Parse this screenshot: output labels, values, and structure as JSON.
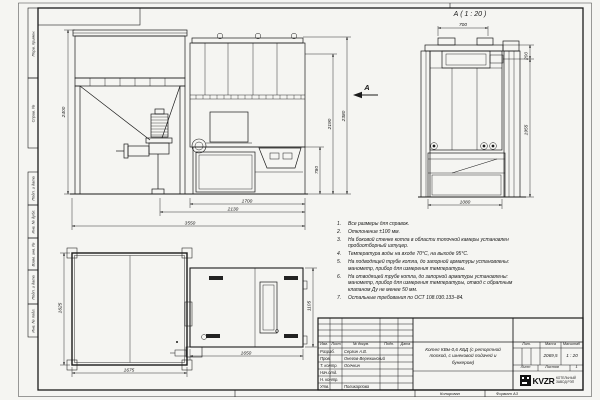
{
  "drawing": {
    "section_label": "А ( 1 : 20 )",
    "view_arrow_label": "А",
    "front_view": {
      "dim_height": "2400",
      "dim_right_1": "780",
      "dim_right_2": "2190",
      "dim_right_3": "2380",
      "dim_bottom_1": "1700",
      "dim_bottom_2": "2130",
      "dim_bottom_3": "3550"
    },
    "section_view": {
      "dim_top": "700",
      "dim_right_1": "200",
      "dim_right_2": "1955",
      "dim_bottom": "1080"
    },
    "plan_view": {
      "dim_left": "1625",
      "dim_bottom_bunker": "1675",
      "dim_bottom_boiler": "1650",
      "dim_right": "1105"
    }
  },
  "notes": {
    "items": [
      {
        "n": "1.",
        "text": "Все размеры для справок."
      },
      {
        "n": "2.",
        "text": "Отклонение ±100 мм."
      },
      {
        "n": "3.",
        "text": "На боковой стенке котла в области топочной камеры установлен пробоотборный штуцер."
      },
      {
        "n": "4.",
        "text": "Температура воды на входе 70°С, на выходе 95°С."
      },
      {
        "n": "5.",
        "text": "На подводящей трубе котла, до запорной арматуры установлены: манометр, прибор для измерения температуры."
      },
      {
        "n": "6.",
        "text": "На отводящей трубе котла, до запорной арматуры установлены: манометр, прибор для измерения температуры, отвод с обратным клапаном Ду не менее 50 мм."
      },
      {
        "n": "7.",
        "text": "Остальные требования по ОСТ 108.030.133–84."
      }
    ]
  },
  "frame_stamps": {
    "top": [
      "Перв. примен.",
      "Справ. №"
    ],
    "bottom": [
      "Подп. и дата",
      "Инв. № дубл.",
      "Взам. инв. №",
      "Подп. и дата",
      "Инв. № подл."
    ]
  },
  "title_block": {
    "col_izm": "Изм.",
    "col_list": "Лист",
    "col_doc": "№ докум.",
    "col_sign": "Подп.",
    "col_date": "Дата",
    "rows": [
      {
        "role": "Разраб.",
        "name": "Сергин А.В."
      },
      {
        "role": "Пров.",
        "name": "Онегов-Вережинский"
      },
      {
        "role": "Т. контр.",
        "name": "Осечкин"
      },
      {
        "role": "Нач.отд.",
        "name": ""
      },
      {
        "role": "Н. контр.",
        "name": ""
      },
      {
        "role": "Утв.",
        "name": "Поликарпова"
      }
    ],
    "title": "Котел КВм-0,6 КБД (с ретортной топкой, с шнековой подачей и бункером)",
    "lit_label": "Лит.",
    "mass_label": "Масса",
    "scale_label": "Масштаб",
    "mass_value": "2069,5",
    "scale_value": "1 : 20",
    "sheet_label": "Лист",
    "sheets_label": "Листов",
    "sheets_value": "1",
    "logo_text": "KVZR",
    "company_line1": "КОТЕЛЬНЫЙ",
    "company_line2": "ЗАВОД РЭП"
  },
  "footer": {
    "copied_label": "Копировал",
    "format_label": "Формат А3"
  }
}
